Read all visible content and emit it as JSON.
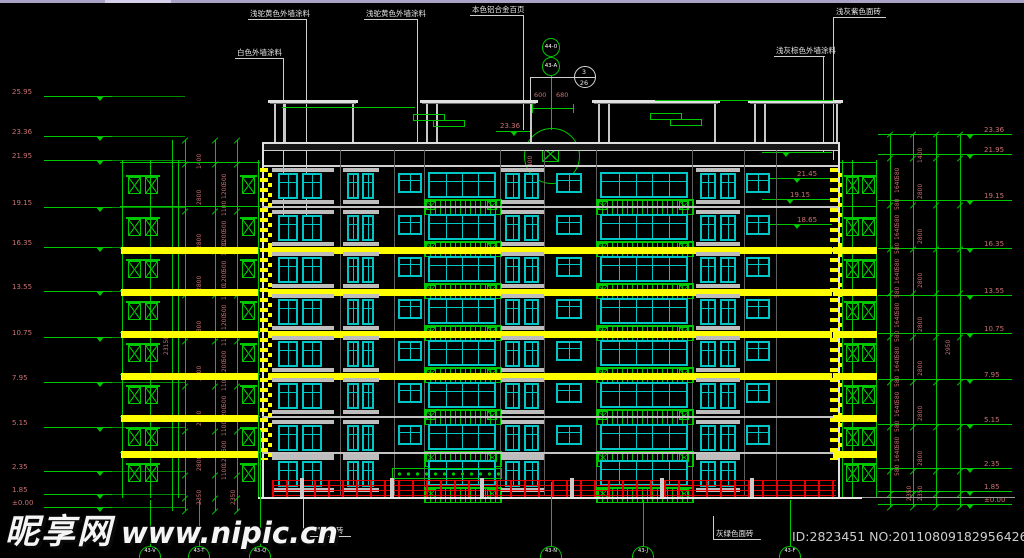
{
  "meta": {
    "drawing_type": "building elevation CAD drawing"
  },
  "colors": {
    "green": "#00c800",
    "cyan": "#00c6c6",
    "yellow": "#ffff00",
    "red": "#e80000",
    "dim_text": "#c97070",
    "white_line": "#e8e8e8",
    "gray_slab": "#bdbdbd",
    "faint_gray": "#8a8a8a"
  },
  "watermark": {
    "site": "昵享网",
    "url": "www.nipic.cn"
  },
  "id_text": "ID:2823451 NO:20110809182956426000",
  "top_annotations": [
    {
      "text": "白色外墙涂料",
      "tx": 237,
      "ty": 49,
      "ux2": 284,
      "dx": 283,
      "dy2": 215
    },
    {
      "text": "浅驼黄色外墙涂料",
      "tx": 250,
      "ty": 10,
      "ux2": 307,
      "dx": 306,
      "dy2": 222
    },
    {
      "text": "浅驼黄色外墙涂料",
      "tx": 366,
      "ty": 10,
      "ux2": 418,
      "dx": 417,
      "dy2": 143
    },
    {
      "text": "本色铝合金百页",
      "tx": 472,
      "ty": 6,
      "ux2": 524,
      "dx": 523,
      "dy2": 130
    },
    {
      "text": "浅灰紫色面砖",
      "tx": 836,
      "ty": 8,
      "ux2": 886,
      "dx": 833,
      "dy2": 160,
      "drop_left": true
    },
    {
      "text": "浅灰棕色外墙涂料",
      "tx": 776,
      "ty": 47,
      "ux2": 825,
      "dx": 823,
      "dy2": 152
    }
  ],
  "bottom_annotations": [
    {
      "text": "灰绿色面砖",
      "tx": 306,
      "ty": 527,
      "lx": 303,
      "ly1": 497
    },
    {
      "text": "灰绿色面砖",
      "tx": 716,
      "ty": 530,
      "lx": 713,
      "ly1": 516
    }
  ],
  "grid_bubbles_top": [
    {
      "label": "44-0",
      "cx": 551,
      "cy": 47
    },
    {
      "label": "43-A",
      "cx": 551,
      "cy": 66
    }
  ],
  "detail_ref": {
    "top": "3",
    "bottom": "26",
    "cx": 585,
    "cy": 77
  },
  "roof": {
    "level": {
      "v": "23.36",
      "x": 500,
      "y": 122
    },
    "dims": [
      "600",
      "680"
    ],
    "detail_dim": "1400",
    "detail_circle": {
      "cx": 551,
      "cy": 155,
      "r": 27
    }
  },
  "levels_left": [
    {
      "v": "25.95",
      "y": 88
    },
    {
      "v": "23.36",
      "y": 128
    },
    {
      "v": "21.95",
      "y": 152
    },
    {
      "v": "19.15",
      "y": 199
    },
    {
      "v": "16.35",
      "y": 239
    },
    {
      "v": "13.55",
      "y": 283
    },
    {
      "v": "10.75",
      "y": 329
    },
    {
      "v": "7.95",
      "y": 374
    },
    {
      "v": "5.15",
      "y": 419
    },
    {
      "v": "2.35",
      "y": 463
    },
    {
      "v": "1.85",
      "y": 486
    },
    {
      "v": "±0.00",
      "y": 499
    }
  ],
  "levels_right": [
    {
      "v": "23.36",
      "y": 126
    },
    {
      "v": "21.95",
      "y": 146
    },
    {
      "v": "19.15",
      "y": 192
    },
    {
      "v": "16.35",
      "y": 240
    },
    {
      "v": "13.55",
      "y": 287
    },
    {
      "v": "10.75",
      "y": 325
    },
    {
      "v": "7.95",
      "y": 371
    },
    {
      "v": "5.15",
      "y": 416
    },
    {
      "v": "2.35",
      "y": 460
    },
    {
      "v": "1.85",
      "y": 483
    },
    {
      "v": "±0.00",
      "y": 496
    }
  ],
  "levels_inner": [
    {
      "v": "21.95",
      "x": 786,
      "y": 144
    },
    {
      "v": "21.45",
      "x": 797,
      "y": 170
    },
    {
      "v": "19.15",
      "x": 790,
      "y": 191
    },
    {
      "v": "18.65",
      "x": 797,
      "y": 216
    }
  ],
  "chain_left": {
    "x_lines": [
      185,
      215,
      237
    ],
    "ys": [
      140,
      164,
      211,
      251,
      295,
      341,
      386,
      431,
      475,
      498,
      511
    ],
    "colA_x": 203,
    "colB_x": 228,
    "colA": [
      [
        "1400",
        146
      ],
      [
        "2800",
        182
      ],
      [
        "2800",
        226
      ],
      [
        "2800",
        268
      ],
      [
        "2800",
        313
      ],
      [
        "2800",
        358
      ],
      [
        "2800",
        403
      ],
      [
        "2800",
        448
      ],
      [
        "2350",
        482
      ]
    ],
    "triplet": [
      "500",
      "1200",
      "1100"
    ],
    "triplet_spans": [
      1,
      2,
      3,
      4,
      5,
      6,
      7
    ],
    "total": {
      "t": "23150",
      "x": 170,
      "y": 330
    },
    "extra": [
      [
        "2350",
        237,
        482
      ]
    ]
  },
  "chain_right": {
    "x_lines": [
      890,
      913,
      936,
      960
    ],
    "ys": [
      134,
      158,
      205,
      249,
      293,
      337,
      382,
      427,
      471,
      494,
      507
    ],
    "colA_x": 901,
    "colB_x": 924,
    "colB": [
      [
        "1400",
        140
      ],
      [
        "2800",
        176
      ],
      [
        "2800",
        221
      ],
      [
        "2800",
        265
      ],
      [
        "2800",
        309
      ],
      [
        "2800",
        353
      ],
      [
        "2800",
        398
      ],
      [
        "2800",
        443
      ],
      [
        "2350",
        478
      ]
    ],
    "tripletA": [
      "580",
      "1640",
      "580"
    ],
    "triplet_spans": [
      1,
      2,
      3,
      4,
      5,
      6,
      7
    ],
    "total": {
      "t": "2950",
      "x": 952,
      "y": 330
    },
    "extra": [
      [
        "2350",
        913,
        478
      ]
    ]
  },
  "facade": {
    "left": 262,
    "right": 838,
    "roof_y": 142,
    "parapet_y": 165,
    "ground_y": 497,
    "row_tops": [
      172,
      214,
      256,
      298,
      340,
      382,
      424,
      460
    ],
    "window_h": 28,
    "yellow_rows": [
      2,
      3,
      4,
      5
    ],
    "bays": [
      {
        "type": "baypair",
        "x": 272,
        "w": 62,
        "wins": [
          [
            278,
            20
          ],
          [
            302,
            20
          ]
        ]
      },
      {
        "type": "baypair",
        "x": 343,
        "w": 36,
        "wins": [
          [
            347,
            12
          ],
          [
            362,
            12
          ]
        ]
      },
      {
        "type": "small",
        "x": 398,
        "w": 24
      },
      {
        "type": "balcony",
        "x": 424,
        "w": 76,
        "win": [
          428,
          68
        ],
        "panes": 4
      },
      {
        "type": "baypair",
        "x": 501,
        "w": 43,
        "wins": [
          [
            505,
            15
          ],
          [
            524,
            15
          ]
        ]
      },
      {
        "type": "small",
        "x": 556,
        "w": 26
      },
      {
        "type": "balcony",
        "x": 596,
        "w": 96,
        "win": [
          600,
          88
        ],
        "panes": 5
      },
      {
        "type": "baypair",
        "x": 696,
        "w": 44,
        "wins": [
          [
            700,
            16
          ],
          [
            720,
            16
          ]
        ]
      },
      {
        "type": "small",
        "x": 746,
        "w": 24
      }
    ],
    "struct_verts": [
      340,
      394,
      424,
      500,
      544,
      596,
      692,
      744,
      776
    ],
    "ground_dots": {
      "x": 392,
      "w": 108
    }
  },
  "pergola": {
    "cap_y": 100,
    "post_y1": 104,
    "post_y2": 142,
    "caps": [
      [
        268,
        358
      ],
      [
        420,
        538
      ],
      [
        592,
        720
      ],
      [
        748,
        843
      ]
    ],
    "posts": [
      274,
      284,
      352,
      426,
      436,
      530,
      598,
      608,
      714,
      754,
      764,
      836
    ],
    "louvers_left": {
      "line": [
        282,
        415,
        107
      ],
      "rects": [
        [
          413,
          114
        ],
        [
          433,
          120
        ]
      ]
    },
    "louvers_right": {
      "line": [
        655,
        833,
        100
      ],
      "rects": [
        [
          650,
          113
        ],
        [
          670,
          119
        ]
      ]
    }
  },
  "annex_left": {
    "x1": 120,
    "x2": 260,
    "verts": [
      122,
      150,
      178,
      258
    ],
    "boxes": [
      128,
      145,
      242
    ],
    "yellow_x": 121,
    "yellow_w": 137
  },
  "annex_right": {
    "x1": 840,
    "x2": 877,
    "verts": [
      842,
      852,
      876
    ],
    "boxes": [
      846,
      862
    ],
    "yellow_x": 833,
    "yellow_w": 44
  },
  "quoins": [
    {
      "x": 260
    },
    {
      "x": 830
    }
  ],
  "red_base": {
    "y": 480,
    "h": 17,
    "x1": 272,
    "x2": 836,
    "piers": [
      300,
      390,
      480,
      570,
      660,
      750
    ]
  },
  "bubbles_bottom": [
    {
      "label": "43-V",
      "x": 150
    },
    {
      "label": "43-T",
      "x": 199
    },
    {
      "label": "43-Q",
      "x": 260
    },
    {
      "label": "43-N",
      "x": 551
    },
    {
      "label": "43-J",
      "x": 643
    },
    {
      "label": "43-F",
      "x": 790
    }
  ]
}
